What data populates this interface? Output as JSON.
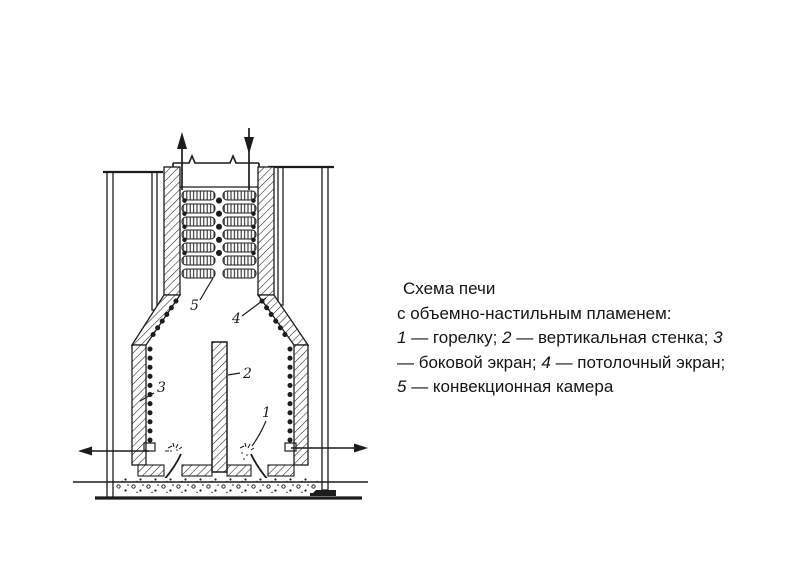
{
  "page": {
    "background_color": "#ffffff",
    "ink_color": "#1c1c1c"
  },
  "diagram": {
    "description": "furnace-schematic",
    "labels": {
      "burner": "1",
      "vertical_wall": "2",
      "side_screen": "3",
      "ceiling_screen": "4",
      "convection_chamber": "5"
    }
  },
  "caption": {
    "lines": {
      "0": {
        "segments": {
          "0": {
            "t": "Схема печи"
          }
        }
      },
      "1": {
        "segments": {
          "0": {
            "t": "с объемно-настильным пламенем:"
          }
        }
      },
      "2": {
        "segments": {
          "0": {
            "t": "1"
          },
          "1": {
            "t": " — горелку; "
          },
          "2": {
            "t": "2"
          },
          "3": {
            "t": " — вертикальная стенка; "
          },
          "4": {
            "t": "3"
          }
        }
      },
      "3": {
        "segments": {
          "0": {
            "t": "— боковой экран; "
          },
          "1": {
            "t": "4"
          },
          "2": {
            "t": " — потолочный экран;"
          }
        }
      },
      "4": {
        "segments": {
          "0": {
            "t": "5"
          },
          "1": {
            "t": " — конвекционная камера"
          }
        }
      }
    }
  }
}
